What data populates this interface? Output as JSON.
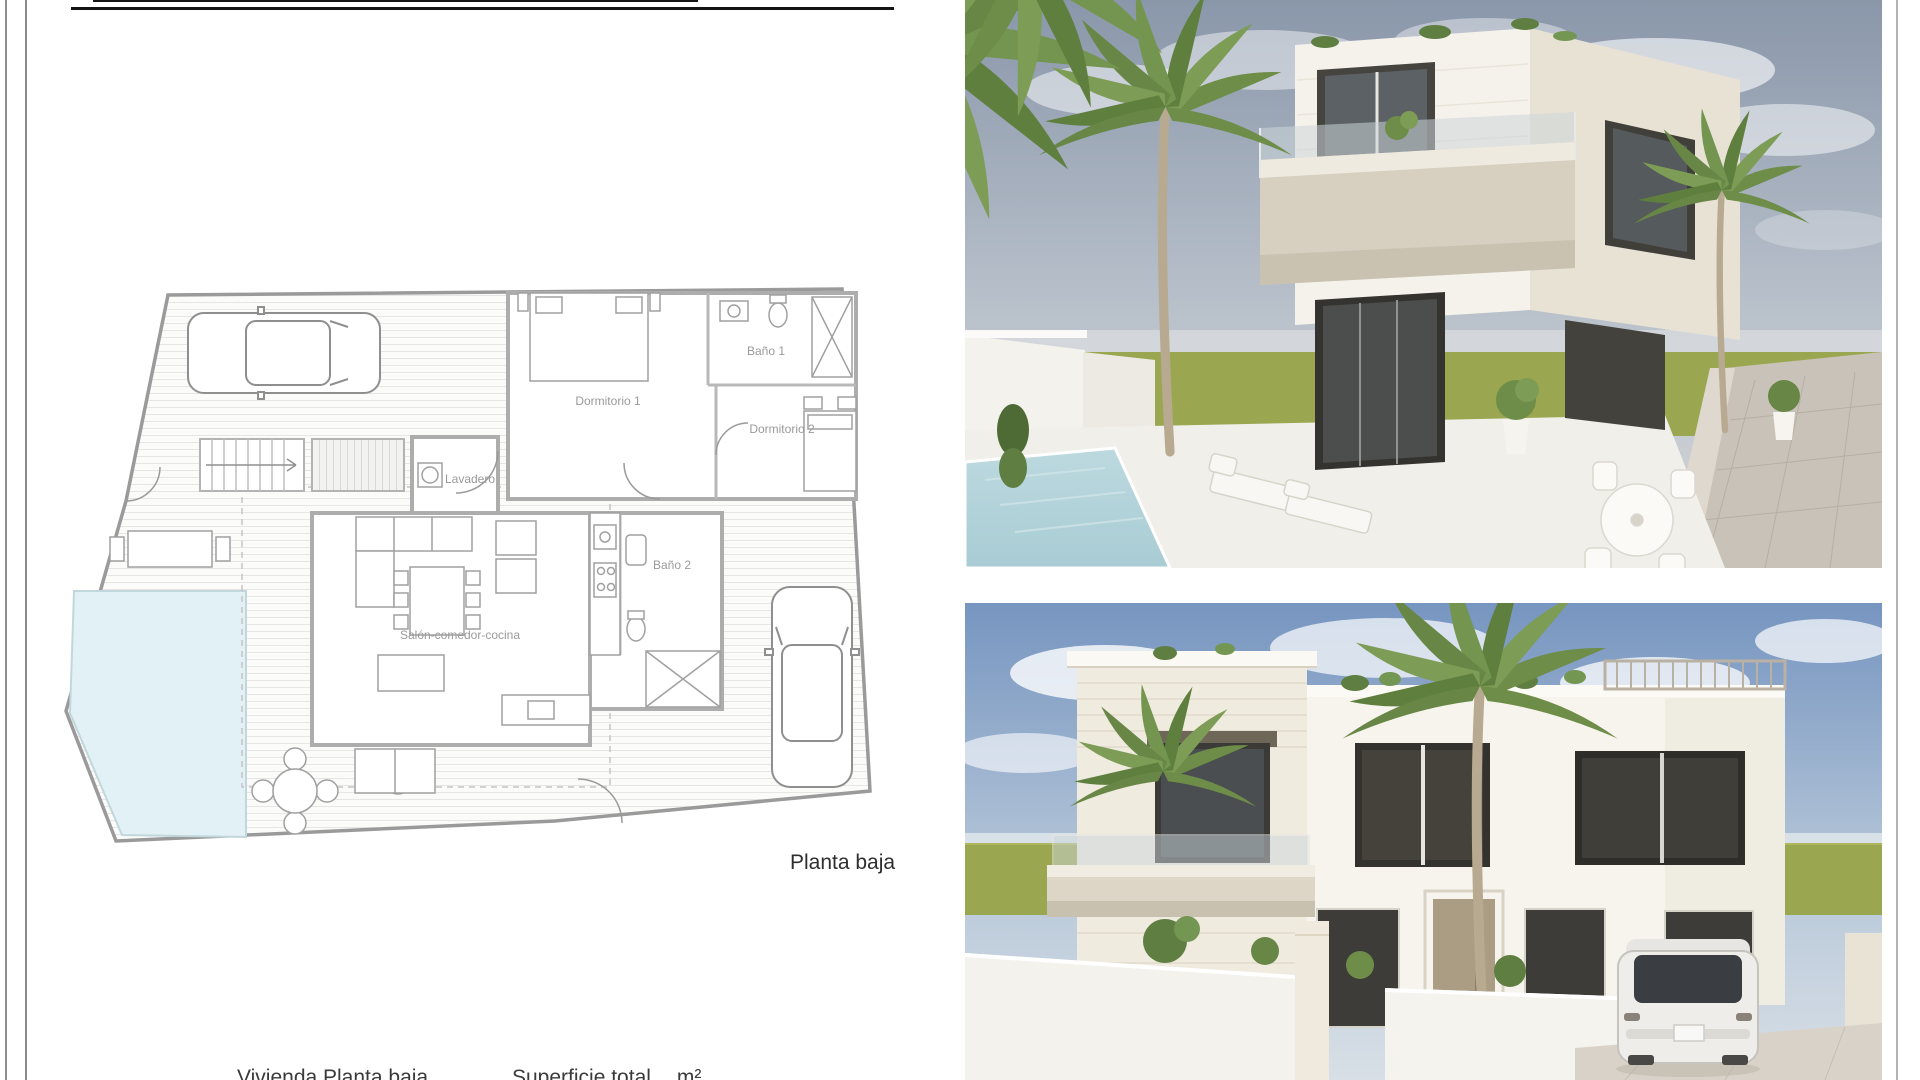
{
  "page": {
    "floor_plan": {
      "labels": {
        "dormitorio1": "Dormitorio 1",
        "bano1": "Baño 1",
        "dormitorio2": "Dormitorio 2",
        "lavadero": "Lavadero",
        "bano2": "Baño 2",
        "salon": "Salón-comedor-cocina"
      },
      "caption": "Planta baja"
    },
    "footer": {
      "left": "Vivienda Planta baja",
      "right": "Superficie total",
      "unit": "m²"
    },
    "colors": {
      "pool": "#e2f1f5",
      "grass": "#9aa750",
      "sky_top_photo1": "#8a97aa",
      "sky_top_photo2": "#7695c0",
      "house_wall": "#f6f3ec",
      "stone": "#efe9dd",
      "plan_wall": "#a8a8a8"
    }
  }
}
